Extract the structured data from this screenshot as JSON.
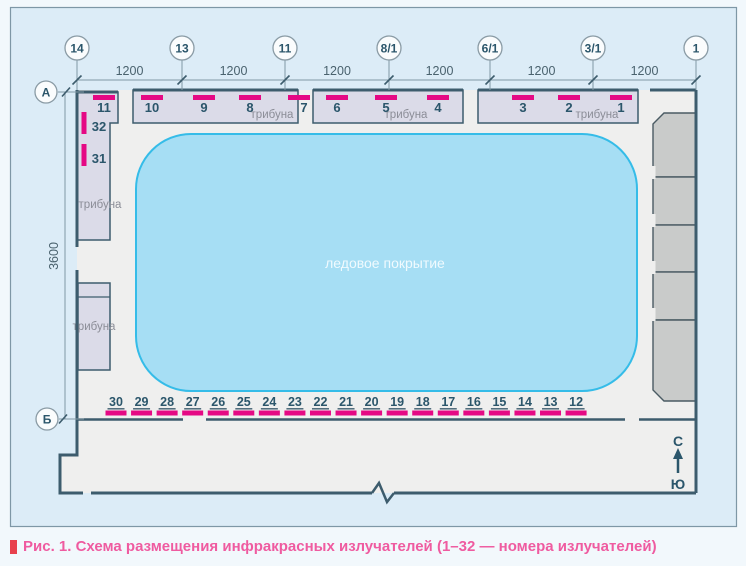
{
  "diagram": {
    "grid_columns": [
      "14",
      "13",
      "11",
      "8/1",
      "6/1",
      "3/1",
      "1"
    ],
    "grid_rows": [
      "А",
      "Б"
    ],
    "dim_horizontal": [
      "1200",
      "1200",
      "1200",
      "1200",
      "1200",
      "1200"
    ],
    "dim_vertical": "3600",
    "ice_label": "ледовое покрытие",
    "tribune_label": "трибуна",
    "emitters_top": [
      [
        "10",
        "9",
        "8",
        "7"
      ],
      [
        "6",
        "5",
        "4"
      ],
      [
        "3",
        "2",
        "1"
      ]
    ],
    "emitter_left": {
      "top": "11",
      "side": [
        "32",
        "31"
      ]
    },
    "emitters_bottom": [
      "30",
      "29",
      "28",
      "27",
      "26",
      "25",
      "24",
      "23",
      "22",
      "21",
      "20",
      "19",
      "18",
      "17",
      "16",
      "15",
      "14",
      "13",
      "12"
    ],
    "compass": {
      "north": "С",
      "south": "Ю"
    },
    "colors": {
      "emitter": "#e50984",
      "wall": "#3d5c6d",
      "ice_fill": "#a6def4",
      "ice_border": "#35bce8",
      "tribune_fill": "#dbdbe8",
      "gray_block": "#c9cbca",
      "frame_fill": "#dcecf7",
      "interior_fill": "#efefee",
      "caption_text": "#ef5ba0",
      "caption_bullet": "#e8414d"
    }
  },
  "caption": {
    "text": "Рис. 1. Схема размещения инфракрасных излучателей (1–32 — номера излучателей)"
  }
}
